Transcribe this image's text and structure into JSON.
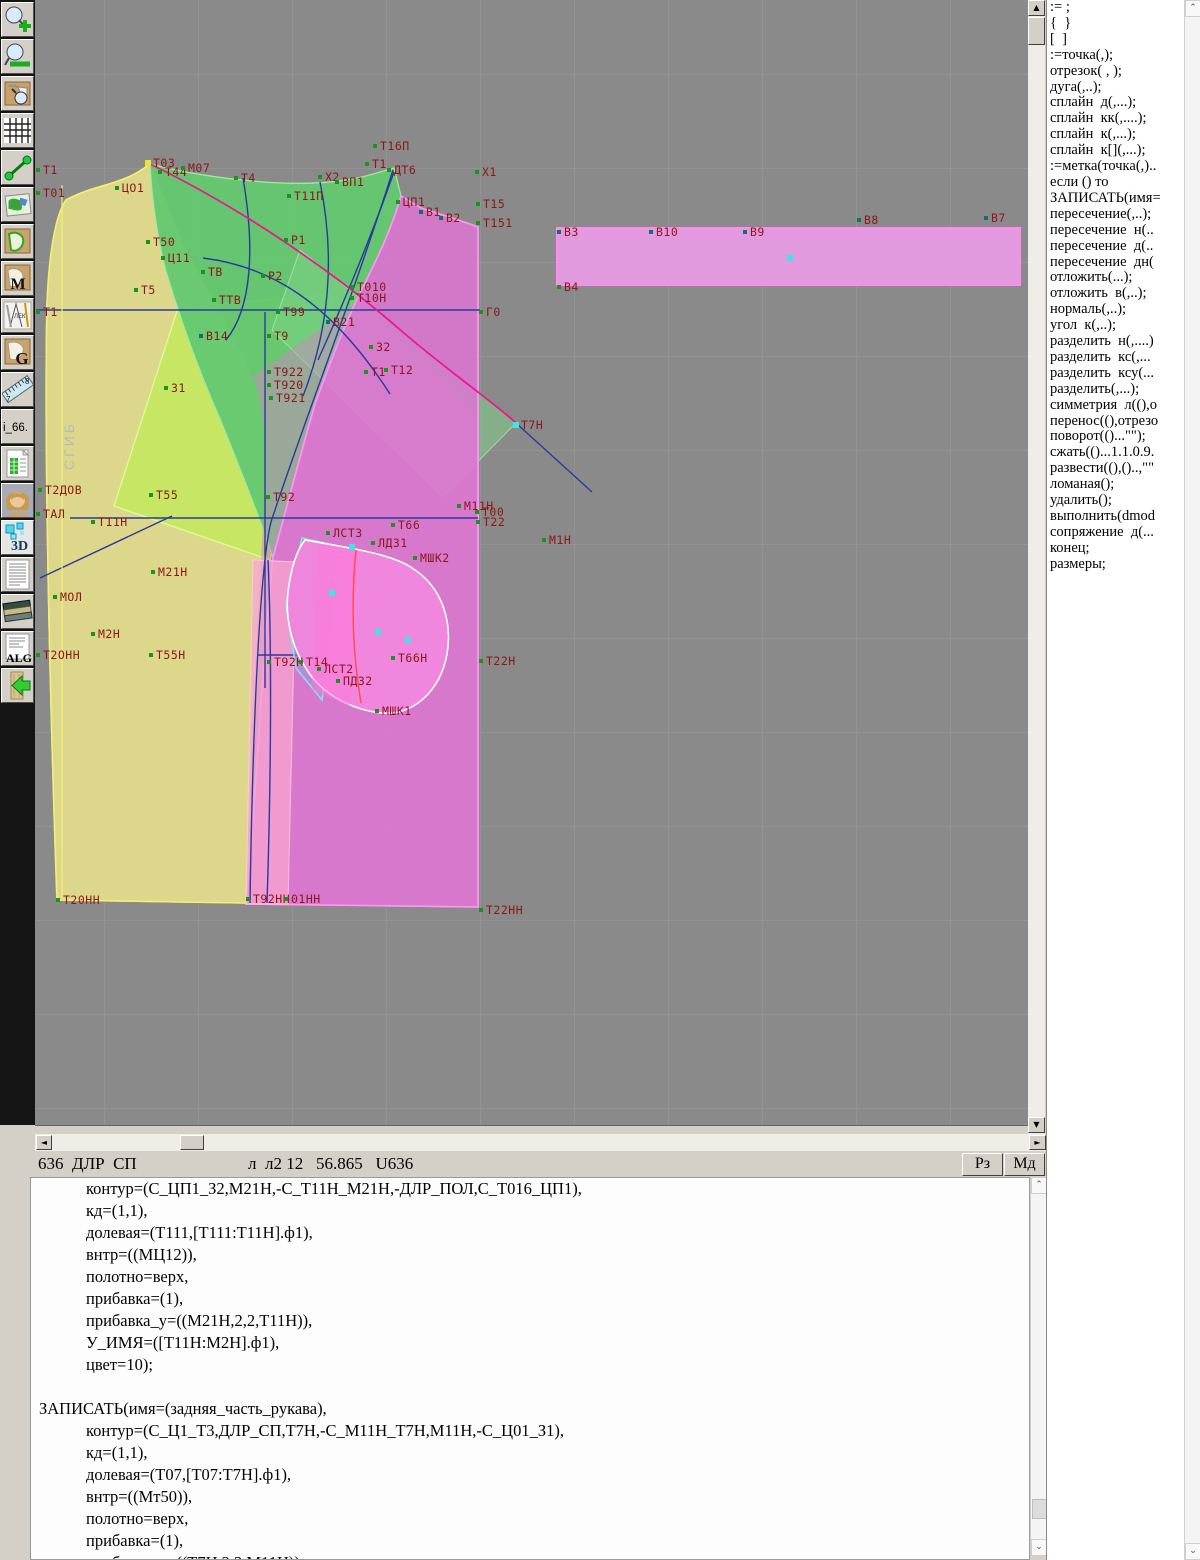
{
  "toolbar": {
    "items": [
      {
        "id": "zoom-in"
      },
      {
        "id": "zoom-out"
      },
      {
        "id": "preview"
      },
      {
        "id": "grid"
      },
      {
        "id": "segment"
      },
      {
        "id": "map"
      },
      {
        "id": "lekalo"
      },
      {
        "id": "lekalo-m",
        "label": "M"
      },
      {
        "id": "drafting"
      },
      {
        "id": "lekalo-g",
        "label": "G"
      },
      {
        "id": "ruler"
      },
      {
        "id": "i66",
        "label": "i_66."
      },
      {
        "id": "table-doc"
      },
      {
        "id": "portrait"
      },
      {
        "id": "three-d",
        "label": "3D"
      },
      {
        "id": "text-doc"
      },
      {
        "id": "books"
      },
      {
        "id": "alg",
        "label": "ALG"
      },
      {
        "id": "exit"
      }
    ]
  },
  "canvas": {
    "fold_label": "СГИБ",
    "points": [
      {
        "t": "Т1",
        "x": 38,
        "y": 170,
        "m": "g"
      },
      {
        "t": "Т01",
        "x": 38,
        "y": 193,
        "m": "g"
      },
      {
        "t": "ЦО1",
        "x": 117,
        "y": 188,
        "m": "g"
      },
      {
        "t": "Т03",
        "x": 148,
        "y": 163,
        "m": "y"
      },
      {
        "t": "Т44",
        "x": 160,
        "y": 172,
        "m": "g"
      },
      {
        "t": "М07",
        "x": 183,
        "y": 168,
        "m": "g"
      },
      {
        "t": "Т4",
        "x": 236,
        "y": 178,
        "m": "g"
      },
      {
        "t": "Х2",
        "x": 320,
        "y": 177,
        "m": "g"
      },
      {
        "t": "ВП1",
        "x": 337,
        "y": 182,
        "m": "g"
      },
      {
        "t": "Т16П",
        "x": 375,
        "y": 146,
        "m": "g"
      },
      {
        "t": "Т1",
        "x": 367,
        "y": 164,
        "m": "g"
      },
      {
        "t": "ДТ6",
        "x": 389,
        "y": 170,
        "m": "g"
      },
      {
        "t": "Т11П",
        "x": 289,
        "y": 196,
        "m": "g"
      },
      {
        "t": "ЦП1",
        "x": 398,
        "y": 202,
        "m": "g"
      },
      {
        "t": "В1",
        "x": 421,
        "y": 212,
        "m": "t"
      },
      {
        "t": "В2",
        "x": 441,
        "y": 218,
        "m": "t"
      },
      {
        "t": "Х1",
        "x": 477,
        "y": 172,
        "m": "g"
      },
      {
        "t": "Т15",
        "x": 478,
        "y": 204,
        "m": "g"
      },
      {
        "t": "Т151",
        "x": 478,
        "y": 223,
        "m": "g"
      },
      {
        "t": "Т50",
        "x": 148,
        "y": 242,
        "m": "g"
      },
      {
        "t": "Ц11",
        "x": 163,
        "y": 258,
        "m": "g"
      },
      {
        "t": "ТВ",
        "x": 203,
        "y": 272,
        "m": "g"
      },
      {
        "t": "Т5",
        "x": 136,
        "y": 290,
        "m": "g"
      },
      {
        "t": "ТТВ",
        "x": 214,
        "y": 300,
        "m": "g"
      },
      {
        "t": "Р1",
        "x": 286,
        "y": 240,
        "m": "g"
      },
      {
        "t": "Р2",
        "x": 263,
        "y": 276,
        "m": "g"
      },
      {
        "t": "Т010",
        "x": 352,
        "y": 287,
        "m": "g"
      },
      {
        "t": "Т10Н",
        "x": 352,
        "y": 298,
        "m": "g"
      },
      {
        "t": "Т1",
        "x": 38,
        "y": 312,
        "m": "g"
      },
      {
        "t": "Т99",
        "x": 278,
        "y": 312,
        "m": "g"
      },
      {
        "t": "В21",
        "x": 328,
        "y": 322,
        "m": "t"
      },
      {
        "t": "Т9",
        "x": 269,
        "y": 336,
        "m": "g"
      },
      {
        "t": "З2",
        "x": 371,
        "y": 347,
        "m": "g"
      },
      {
        "t": "Г0",
        "x": 481,
        "y": 312,
        "m": "g"
      },
      {
        "t": "В14",
        "x": 201,
        "y": 336,
        "m": "t"
      },
      {
        "t": "Т922",
        "x": 269,
        "y": 372,
        "m": "g"
      },
      {
        "t": "Т920",
        "x": 269,
        "y": 385,
        "m": "g"
      },
      {
        "t": "Т921",
        "x": 271,
        "y": 398,
        "m": "g"
      },
      {
        "t": "Т1",
        "x": 366,
        "y": 372,
        "m": "g"
      },
      {
        "t": "Т12",
        "x": 386,
        "y": 370,
        "m": "g"
      },
      {
        "t": "З1",
        "x": 166,
        "y": 388,
        "m": "g"
      },
      {
        "t": "Т7Н",
        "x": 516,
        "y": 425,
        "m": "c"
      },
      {
        "t": "Т2ДОВ",
        "x": 40,
        "y": 490,
        "m": "g"
      },
      {
        "t": "ТАЛ",
        "x": 38,
        "y": 514,
        "m": "g"
      },
      {
        "t": "Т55",
        "x": 151,
        "y": 495,
        "m": "g"
      },
      {
        "t": "Т92",
        "x": 268,
        "y": 497,
        "m": "g"
      },
      {
        "t": "Т11Н",
        "x": 93,
        "y": 522,
        "m": "g"
      },
      {
        "t": "М21Н",
        "x": 153,
        "y": 572,
        "m": "g"
      },
      {
        "t": "МОЛ",
        "x": 55,
        "y": 597,
        "m": "g"
      },
      {
        "t": "М2Н",
        "x": 93,
        "y": 634,
        "m": "g"
      },
      {
        "t": "Т55Н",
        "x": 151,
        "y": 655,
        "m": "g"
      },
      {
        "t": "Т2ОНН",
        "x": 38,
        "y": 655,
        "m": "g"
      },
      {
        "t": "М11Н",
        "x": 459,
        "y": 506,
        "m": "g"
      },
      {
        "t": "Т00",
        "x": 477,
        "y": 512,
        "m": "g"
      },
      {
        "t": "Т22",
        "x": 478,
        "y": 522,
        "m": "g"
      },
      {
        "t": "Т66",
        "x": 393,
        "y": 525,
        "m": "g"
      },
      {
        "t": "М1Н",
        "x": 544,
        "y": 540,
        "m": "g"
      },
      {
        "t": "ЛСТ3",
        "x": 328,
        "y": 533,
        "m": "g"
      },
      {
        "t": "ЛД31",
        "x": 373,
        "y": 543,
        "m": "g"
      },
      {
        "t": "МШК2",
        "x": 415,
        "y": 558,
        "m": "g"
      },
      {
        "t": "Т66Н",
        "x": 393,
        "y": 658,
        "m": "g"
      },
      {
        "t": "Т22Н",
        "x": 481,
        "y": 661,
        "m": "g"
      },
      {
        "t": "Т92Н",
        "x": 269,
        "y": 662,
        "m": "g"
      },
      {
        "t": "Т14",
        "x": 301,
        "y": 662,
        "m": "g"
      },
      {
        "t": "ЛСТ2",
        "x": 319,
        "y": 669,
        "m": "g"
      },
      {
        "t": "ПД32",
        "x": 338,
        "y": 681,
        "m": "g"
      },
      {
        "t": "МШК1",
        "x": 377,
        "y": 711,
        "m": "g"
      },
      {
        "t": "Т20НН",
        "x": 58,
        "y": 900,
        "m": "g"
      },
      {
        "t": "Т92НН",
        "x": 248,
        "y": 899,
        "m": "g"
      },
      {
        "t": "01НН",
        "x": 286,
        "y": 899,
        "m": "g"
      },
      {
        "t": "Т22НН",
        "x": 481,
        "y": 910,
        "m": "g"
      },
      {
        "t": "В3",
        "x": 559,
        "y": 232,
        "m": "t"
      },
      {
        "t": "В10",
        "x": 651,
        "y": 232,
        "m": "t"
      },
      {
        "t": "В9",
        "x": 745,
        "y": 232,
        "m": "t"
      },
      {
        "t": "В8",
        "x": 859,
        "y": 220,
        "m": "t"
      },
      {
        "t": "В7",
        "x": 986,
        "y": 218,
        "m": "t"
      },
      {
        "t": "В4",
        "x": 559,
        "y": 287,
        "m": "g"
      },
      {
        "t": "",
        "x": 790,
        "y": 258,
        "m": "c"
      },
      {
        "t": "",
        "x": 352,
        "y": 547,
        "m": "c"
      },
      {
        "t": "",
        "x": 332,
        "y": 593,
        "m": "c"
      },
      {
        "t": "",
        "x": 378,
        "y": 632,
        "m": "c"
      },
      {
        "t": "",
        "x": 408,
        "y": 640,
        "m": "c"
      }
    ]
  },
  "right_panel": {
    "lines": [
      ":= ;",
      "{  }",
      "[  ]",
      ":=точка(,);",
      "отрезок( , );",
      "дуга(,..);",
      "сплайн  д(,...);",
      "сплайн  кк(,....);",
      "сплайн  к(,...);",
      "сплайн  к[](,...);",
      ":=метка(точка(,)..",
      "если () то",
      "ЗАПИСАТЬ(имя=",
      "пересечение(,..);",
      "пересечение  н(..",
      "пересечение  д(..",
      "пересечение  дн(",
      "отложить(...);",
      "отложить  в(,..);",
      "нормаль(,..);",
      "угол  к(,..);",
      "разделить  н(,....)",
      "разделить  кс(,...",
      "разделить  ксу(...",
      "разделить(,...);",
      "симметрия  л((),о",
      "перенос((),отрезо",
      "поворот(()...\"\");",
      "сжать(()...1.1.0.9.",
      "развести((),()..,\"\"",
      "ломаная();",
      "удалить();",
      "выполнить(dmod",
      "сопряжение  д(...",
      "конец;",
      "размеры;"
    ]
  },
  "status": {
    "left": "636  ДЛР  СП",
    "info": "л  л2 12   56.865   U636",
    "rz": "Рз",
    "md": "Мд"
  },
  "code": {
    "lines": [
      {
        "i": 1,
        "t": "контур=(С_ЦП1_З2,М21Н,-С_Т11Н_М21Н,-ДЛР_ПОЛ,С_Т016_ЦП1),"
      },
      {
        "i": 1,
        "t": "кд=(1,1),"
      },
      {
        "i": 1,
        "t": "долевая=(Т111,[Т111:Т11Н].ф1),"
      },
      {
        "i": 1,
        "t": "внтр=((МЦ12)),"
      },
      {
        "i": 1,
        "t": "полотно=верх,"
      },
      {
        "i": 1,
        "t": "прибавка=(1),"
      },
      {
        "i": 1,
        "t": "прибавка_у=((М21Н,2,2,Т11Н)),"
      },
      {
        "i": 1,
        "t": "У_ИМЯ=([Т11Н:М2Н].ф1),"
      },
      {
        "i": 1,
        "t": "цвет=10);"
      },
      {
        "i": 0,
        "t": ""
      },
      {
        "i": 0,
        "t": "ЗАПИСАТЬ(имя=(задняя_часть_рукава),"
      },
      {
        "i": 1,
        "t": "контур=(С_Ц1_Т3,ДЛР_СП,Т7Н,-С_М11Н_Т7Н,М11Н,-С_Ц01_З1),"
      },
      {
        "i": 1,
        "t": "кд=(1,1),"
      },
      {
        "i": 1,
        "t": "долевая=(Т07,[Т07:Т7Н].ф1),"
      },
      {
        "i": 1,
        "t": "внтр=((Мт50)),"
      },
      {
        "i": 1,
        "t": "полотно=верх,"
      },
      {
        "i": 1,
        "t": "прибавка=(1),"
      },
      {
        "i": 1,
        "t": "прибавка_у=((Т7Н,2,2,М11Н)),"
      },
      {
        "i": 1,
        "t": "У_ИМЯ=([Т7Н:М1Н].ф1+180)"
      }
    ]
  }
}
